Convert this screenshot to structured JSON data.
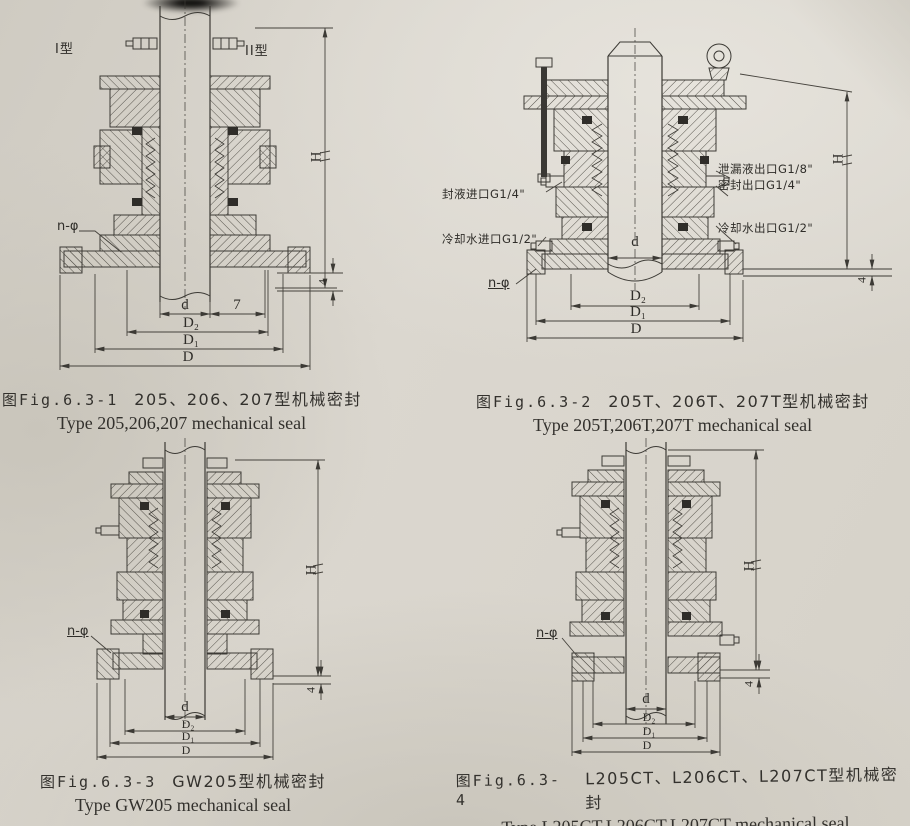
{
  "palette": {
    "paper": "#d7d3ca",
    "ink": "#3c3a35",
    "solid_part": "#2f2d29"
  },
  "figures": [
    {
      "fig_no": "图Fig.6.3-1",
      "title_zh": "205、206、207型机械密封",
      "title_en": "Type 205,206,207 mechanical seal",
      "labels": {
        "type_left": "I型",
        "type_right": "II型",
        "n_phi": "n-φ",
        "h": "H",
        "four": "4",
        "d": "d",
        "seven": "7",
        "d2": "D₂",
        "d1": "D₁",
        "d_out": "D"
      }
    },
    {
      "fig_no": "图Fig.6.3-2",
      "title_zh": "205T、206T、207T型机械密封",
      "title_en": "Type 205T,206T,207T mechanical seal",
      "labels": {
        "n_phi": "n-φ",
        "h": "H",
        "four": "4",
        "d": "d",
        "d2": "D₂",
        "d1": "D₁",
        "d_out": "D"
      },
      "ports_left": [
        "封液进口G1/4\"",
        "冷却水进口G1/2\""
      ],
      "ports_right": [
        "泄漏液出口G1/8\"",
        "密封出口G1/4\"",
        "冷却水出口G1/2\""
      ]
    },
    {
      "fig_no": "图Fig.6.3-3",
      "title_zh": "GW205型机械密封",
      "title_en": "Type GW205 mechanical seal",
      "labels": {
        "n_phi": "n-φ",
        "h": "H",
        "four": "4",
        "d": "d",
        "d2": "D₂",
        "d1": "D₁",
        "d_out": "D"
      }
    },
    {
      "fig_no": "图Fig.6.3-4",
      "title_zh": "L205CT、L206CT、L207CT型机械密封",
      "title_en": "Type L205CT,L206CT,L207CT mechanical seal",
      "labels": {
        "n_phi": "n-φ",
        "h": "H",
        "four": "4",
        "d": "d",
        "d2": "D₂",
        "d1": "D₁",
        "d_out": "D"
      }
    }
  ]
}
